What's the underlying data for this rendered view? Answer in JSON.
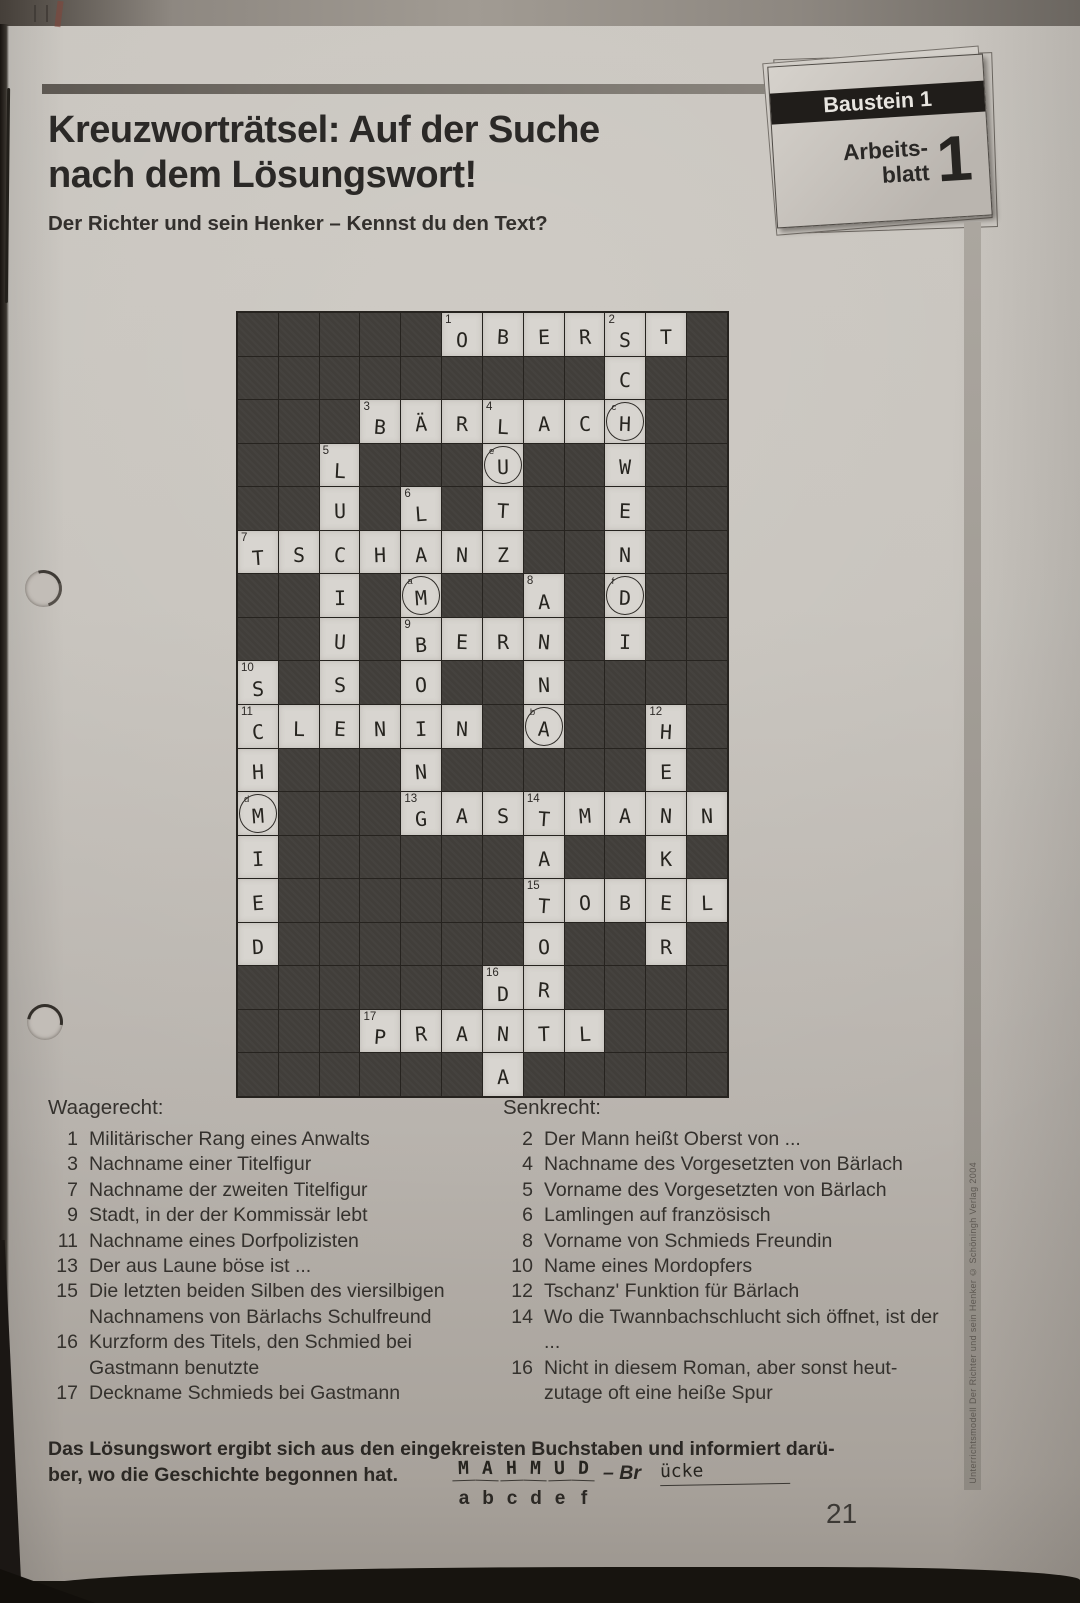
{
  "page": {
    "title_line1": "Kreuzworträtsel: Auf der Suche",
    "title_line2": "nach dem Lösungswort!",
    "subtitle": "Der Richter und sein Henker – Kennst du den Text?",
    "page_number": "21",
    "side_caption": "Unterrichtsmodell Der Richter und sein Henker © Schöningh Verlag 2004",
    "badge": {
      "baustein": "Baustein 1",
      "arbeits_line1": "Arbeits-",
      "arbeits_line2": "blatt",
      "number": "1"
    }
  },
  "crossword": {
    "rows": 18,
    "cols": 12,
    "cells": [
      [
        0,
        5,
        "O",
        "1",
        ""
      ],
      [
        0,
        6,
        "B",
        "",
        ""
      ],
      [
        0,
        7,
        "E",
        "",
        ""
      ],
      [
        0,
        8,
        "R",
        "",
        ""
      ],
      [
        0,
        9,
        "S",
        "2",
        ""
      ],
      [
        0,
        10,
        "T",
        "",
        ""
      ],
      [
        1,
        9,
        "C",
        "",
        ""
      ],
      [
        2,
        3,
        "B",
        "3",
        ""
      ],
      [
        2,
        4,
        "Ä",
        "",
        ""
      ],
      [
        2,
        5,
        "R",
        "",
        ""
      ],
      [
        2,
        6,
        "L",
        "4",
        ""
      ],
      [
        2,
        7,
        "A",
        "",
        ""
      ],
      [
        2,
        8,
        "C",
        "",
        ""
      ],
      [
        2,
        9,
        "H",
        "",
        "c"
      ],
      [
        3,
        2,
        "L",
        "5",
        ""
      ],
      [
        3,
        6,
        "U",
        "",
        "e"
      ],
      [
        3,
        9,
        "W",
        "",
        ""
      ],
      [
        4,
        2,
        "U",
        "",
        ""
      ],
      [
        4,
        4,
        "L",
        "6",
        ""
      ],
      [
        4,
        6,
        "T",
        "",
        ""
      ],
      [
        4,
        9,
        "E",
        "",
        ""
      ],
      [
        5,
        0,
        "T",
        "7",
        ""
      ],
      [
        5,
        1,
        "S",
        "",
        ""
      ],
      [
        5,
        2,
        "C",
        "",
        ""
      ],
      [
        5,
        3,
        "H",
        "",
        ""
      ],
      [
        5,
        4,
        "A",
        "",
        ""
      ],
      [
        5,
        5,
        "N",
        "",
        ""
      ],
      [
        5,
        6,
        "Z",
        "",
        ""
      ],
      [
        5,
        9,
        "N",
        "",
        ""
      ],
      [
        6,
        2,
        "I",
        "",
        ""
      ],
      [
        6,
        4,
        "M",
        "",
        "a"
      ],
      [
        6,
        7,
        "A",
        "8",
        ""
      ],
      [
        6,
        9,
        "D",
        "",
        "f"
      ],
      [
        7,
        2,
        "U",
        "",
        ""
      ],
      [
        7,
        4,
        "B",
        "9",
        ""
      ],
      [
        7,
        5,
        "E",
        "",
        ""
      ],
      [
        7,
        6,
        "R",
        "",
        ""
      ],
      [
        7,
        7,
        "N",
        "",
        ""
      ],
      [
        7,
        9,
        "I",
        "",
        ""
      ],
      [
        8,
        0,
        "S",
        "10",
        ""
      ],
      [
        8,
        2,
        "S",
        "",
        ""
      ],
      [
        8,
        4,
        "O",
        "",
        ""
      ],
      [
        8,
        7,
        "N",
        "",
        ""
      ],
      [
        9,
        0,
        "C",
        "11",
        ""
      ],
      [
        9,
        1,
        "L",
        "",
        ""
      ],
      [
        9,
        2,
        "E",
        "",
        ""
      ],
      [
        9,
        3,
        "N",
        "",
        ""
      ],
      [
        9,
        4,
        "I",
        "",
        ""
      ],
      [
        9,
        5,
        "N",
        "",
        ""
      ],
      [
        9,
        7,
        "A",
        "",
        "b"
      ],
      [
        9,
        10,
        "H",
        "12",
        ""
      ],
      [
        10,
        0,
        "H",
        "",
        ""
      ],
      [
        10,
        4,
        "N",
        "",
        ""
      ],
      [
        10,
        10,
        "E",
        "",
        ""
      ],
      [
        11,
        0,
        "M",
        "",
        "d"
      ],
      [
        11,
        4,
        "G",
        "13",
        ""
      ],
      [
        11,
        5,
        "A",
        "",
        ""
      ],
      [
        11,
        6,
        "S",
        "",
        ""
      ],
      [
        11,
        7,
        "T",
        "14",
        ""
      ],
      [
        11,
        8,
        "M",
        "",
        ""
      ],
      [
        11,
        9,
        "A",
        "",
        ""
      ],
      [
        11,
        10,
        "N",
        "",
        ""
      ],
      [
        11,
        11,
        "N",
        "",
        ""
      ],
      [
        12,
        0,
        "I",
        "",
        ""
      ],
      [
        12,
        7,
        "A",
        "",
        ""
      ],
      [
        12,
        10,
        "K",
        "",
        ""
      ],
      [
        13,
        0,
        "E",
        "",
        ""
      ],
      [
        13,
        7,
        "T",
        "15",
        ""
      ],
      [
        13,
        8,
        "O",
        "",
        ""
      ],
      [
        13,
        9,
        "B",
        "",
        ""
      ],
      [
        13,
        10,
        "E",
        "",
        ""
      ],
      [
        13,
        11,
        "L",
        "",
        ""
      ],
      [
        14,
        0,
        "D",
        "",
        ""
      ],
      [
        14,
        7,
        "O",
        "",
        ""
      ],
      [
        14,
        10,
        "R",
        "",
        ""
      ],
      [
        15,
        6,
        "D",
        "16",
        ""
      ],
      [
        15,
        7,
        "R",
        "",
        ""
      ],
      [
        16,
        3,
        "P",
        "17",
        ""
      ],
      [
        16,
        4,
        "R",
        "",
        ""
      ],
      [
        16,
        5,
        "A",
        "",
        ""
      ],
      [
        16,
        6,
        "N",
        "",
        ""
      ],
      [
        16,
        7,
        "T",
        "",
        ""
      ],
      [
        16,
        8,
        "L",
        "",
        ""
      ],
      [
        17,
        6,
        "A",
        "",
        ""
      ]
    ]
  },
  "clues": {
    "across_title": "Waagerecht:",
    "across": [
      {
        "num": "1",
        "text": "Militärischer Rang eines Anwalts"
      },
      {
        "num": "3",
        "text": "Nachname einer Titelfigur"
      },
      {
        "num": "7",
        "text": "Nachname der zweiten Titelfigur"
      },
      {
        "num": "9",
        "text": "Stadt, in der der Kommissär lebt"
      },
      {
        "num": "11",
        "text": "Nachname eines Dorfpolizisten"
      },
      {
        "num": "13",
        "text": "Der aus Laune böse ist ..."
      },
      {
        "num": "15",
        "text": "Die letzten beiden Silben des viersilbigen Nachnamens von Bärlachs Schulfreund"
      },
      {
        "num": "16",
        "text": "Kurzform des Titels, den Schmied bei Gastmann benutzte"
      },
      {
        "num": "17",
        "text": "Deckname Schmieds bei Gastmann"
      }
    ],
    "down_title": "Senkrecht:",
    "down": [
      {
        "num": "2",
        "text": "Der Mann heißt Oberst von ..."
      },
      {
        "num": "4",
        "text": "Nachname des Vorgesetzten von Bärlach"
      },
      {
        "num": "5",
        "text": "Vorname des Vorgesetzten von Bärlach"
      },
      {
        "num": "6",
        "text": "Lamlingen auf französisch"
      },
      {
        "num": "8",
        "text": "Vorname von Schmieds Freundin"
      },
      {
        "num": "10",
        "text": "Name eines Mordopfers"
      },
      {
        "num": "12",
        "text": "Tschanz' Funktion für Bärlach"
      },
      {
        "num": "14",
        "text": "Wo die Twannbachschlucht sich öffnet, ist der ..."
      },
      {
        "num": "16",
        "text": "Nicht in diesem Roman, aber sonst heut-zutage oft eine heiße Spur"
      }
    ]
  },
  "solution": {
    "text_line1": "Das Lösungswort ergibt sich aus den eingekreisten Buchstaben und informiert darü-",
    "text_line2_prefix": "ber, wo die Geschichte begonnen hat.",
    "handwritten_letters": [
      "M",
      "A",
      "H",
      "M",
      "U",
      "D"
    ],
    "dash_prefix": "– Br",
    "handwritten_suffix": "ücke",
    "letter_labels": [
      "a",
      "b",
      "c",
      "d",
      "e",
      "f"
    ]
  }
}
